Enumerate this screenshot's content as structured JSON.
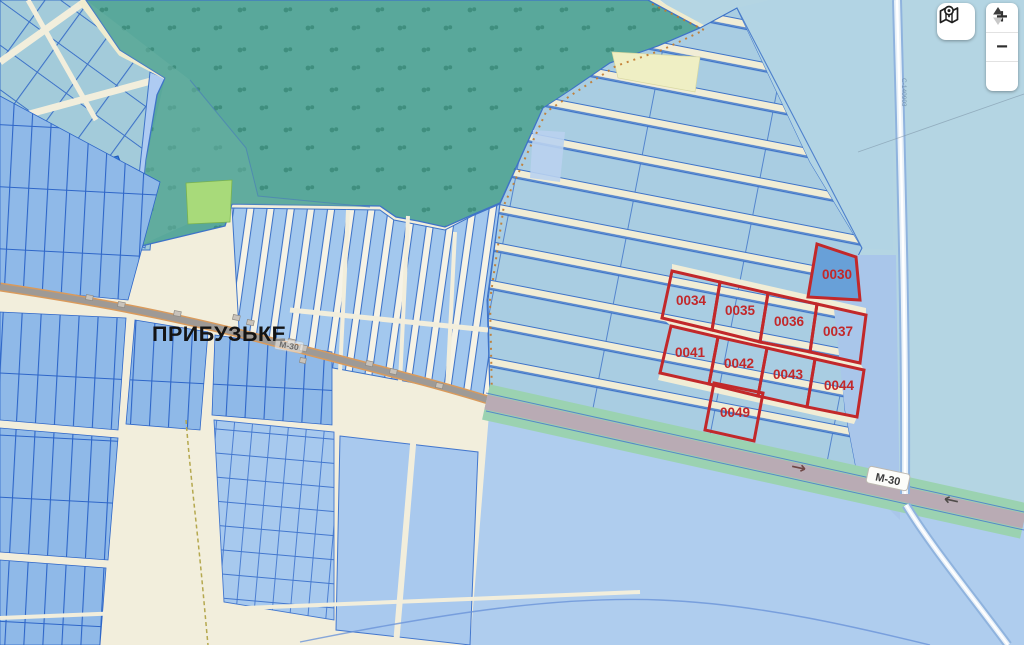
{
  "map": {
    "place_label": "ПРИБУЗЬКЕ",
    "highway_label": "М-30",
    "village_road_label": "М-30",
    "side_road_label": "С-140903",
    "parcels": {
      "p0030": "0030",
      "p0034": "0034",
      "p0035": "0035",
      "p0036": "0036",
      "p0037": "0037",
      "p0041": "0041",
      "p0042": "0042",
      "p0043": "0043",
      "p0044": "0044",
      "p0049": "0049"
    }
  },
  "controls": {
    "zoom_in_label": "+",
    "zoom_out_label": "−",
    "map_button_icon": "map-location-icon",
    "tilt_control_icon": "up-down-arrows-icon"
  },
  "colors": {
    "highlight_red": "#C2282A",
    "highlight_parcel_fill": "#68A0D8",
    "forest_green": "#59A89B",
    "forest_glyph": "#3F8E7E",
    "field_blue": "#A9CDE2",
    "parcel_outline_blue": "#3E73C8",
    "road_cream": "#F2EEDC",
    "highway_surface": "#B9ABB4",
    "highway_verge": "#9BD2B1",
    "lower_field_blue": "#AFCDEE",
    "pond_blue": "#2E7CD8",
    "green_field": "#A8DA7A"
  }
}
